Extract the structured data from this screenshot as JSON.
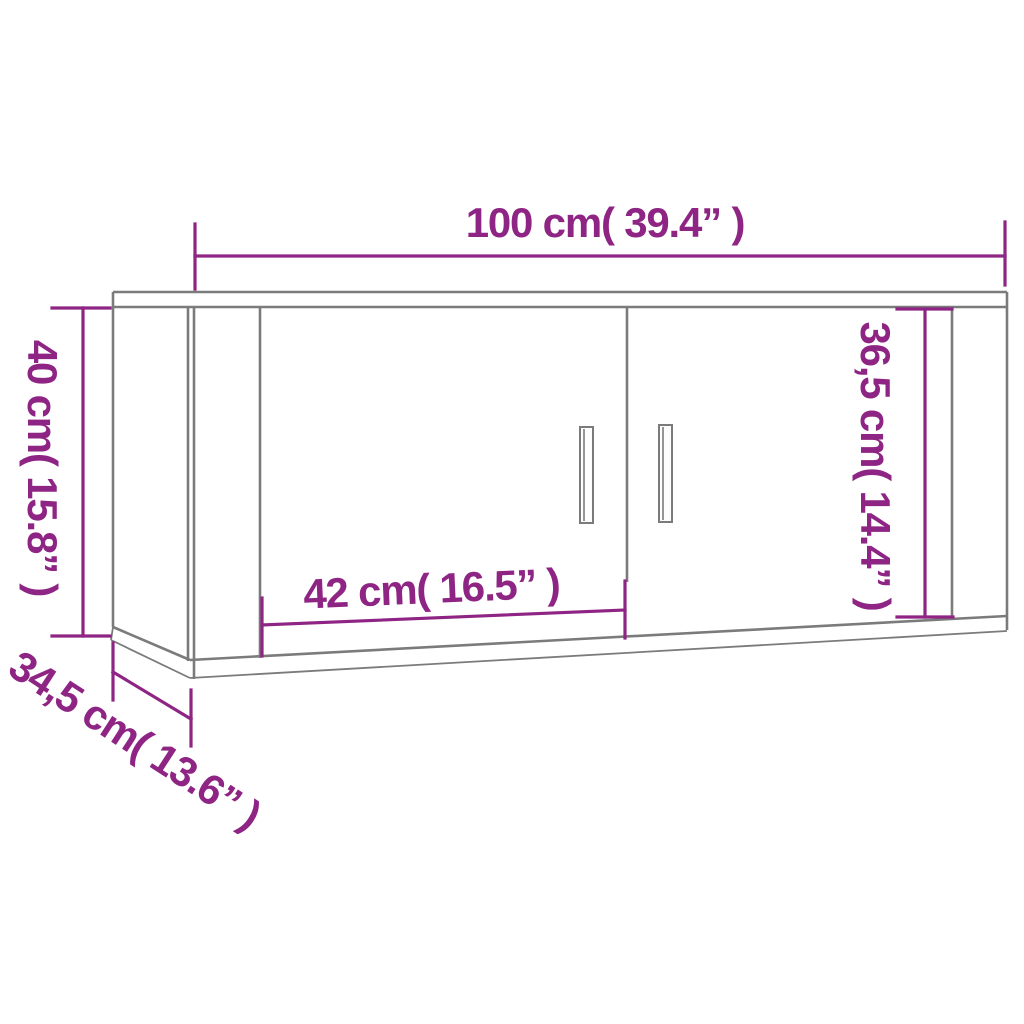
{
  "title": "Wall-mounted cabinet dimension diagram",
  "colors": {
    "dimension": "#8E2483",
    "outline": "#7B7B7B",
    "background": "#FFFFFF"
  },
  "dimensions": {
    "total_width": {
      "text": "100 cm( 39.4” )",
      "cm": 100,
      "inches": 39.4
    },
    "total_height": {
      "text": "40 cm( 15.8” )",
      "cm": 40,
      "inches": 15.8
    },
    "door_height": {
      "text": "36,5 cm( 14.4” )",
      "cm": 36.5,
      "inches": 14.4
    },
    "door_width": {
      "text": "42 cm( 16.5” )",
      "cm": 42,
      "inches": 16.5
    },
    "depth": {
      "text": "34,5 cm( 13.6” )",
      "cm": 34.5,
      "inches": 13.6
    }
  }
}
